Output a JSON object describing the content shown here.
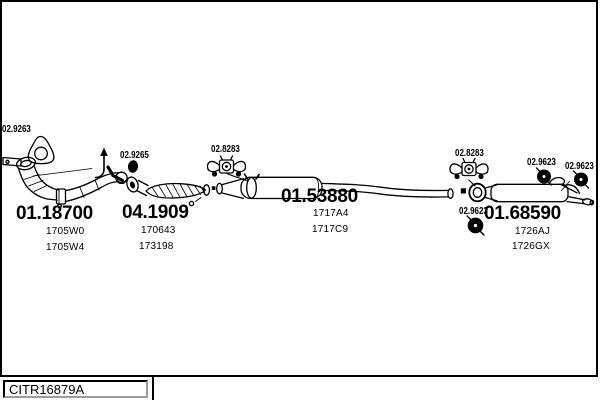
{
  "colors": {
    "line": "#000000",
    "background": "#ffffff"
  },
  "diagram": {
    "part_labels": [
      {
        "code": "02.9263",
        "icon": "gasket-icon"
      },
      {
        "code": "02.9265",
        "icon": "clamp-icon"
      },
      {
        "code": "02.8283",
        "icon": "rubber-hanger-icon"
      },
      {
        "code": "02.8283",
        "icon": "rubber-hanger-icon"
      },
      {
        "code": "02.9623",
        "icon": "grommet-icon"
      },
      {
        "code": "02.9623",
        "icon": "grommet-icon"
      },
      {
        "code": "02.9623",
        "icon": "grommet-icon"
      }
    ],
    "assemblies": [
      {
        "code": "01.18700",
        "refs": [
          "1705W0",
          "1705W4"
        ]
      },
      {
        "code": "04.1909",
        "refs": [
          "170643",
          "173198"
        ]
      },
      {
        "code": "01.53880",
        "refs": [
          "1717A4",
          "1717C9"
        ]
      },
      {
        "code": "01.68590",
        "refs": [
          "1726AJ",
          "1726GX"
        ]
      }
    ],
    "footer": {
      "ref": "CITR16879A"
    }
  }
}
